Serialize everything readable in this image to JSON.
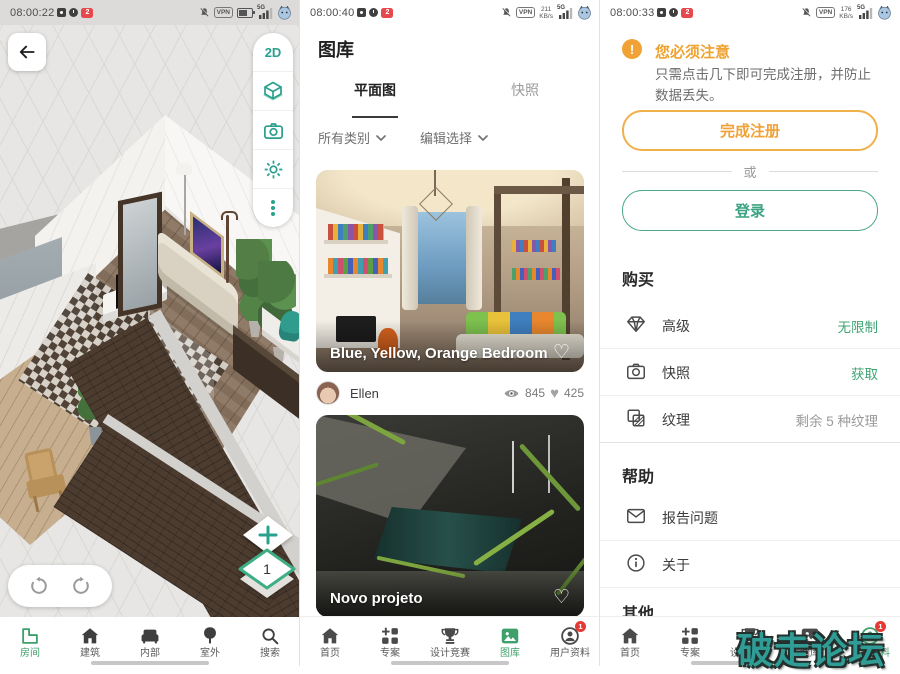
{
  "glyphs": {
    "heart_outline": "♡",
    "heart_filled": "♥",
    "plus": "+",
    "warning_mark": "!",
    "vpn": "VPN",
    "signal_5g": "5G"
  },
  "colors": {
    "accent_teal": "#2aa18f",
    "accent_green": "#3fa06c",
    "accent_orange": "#f0a236",
    "watermark_teal": "#2f9d95"
  },
  "watermark": "破走论坛",
  "panels": {
    "viewer": {
      "status": {
        "time": "08:00:22",
        "badge": "2"
      },
      "toolbar": {
        "mode_2d": "2D"
      },
      "controls": {
        "floor_level": "1"
      },
      "nav": [
        {
          "label": "房间",
          "active": true
        },
        {
          "label": "建筑"
        },
        {
          "label": "内部"
        },
        {
          "label": "室外"
        },
        {
          "label": "搜索"
        }
      ]
    },
    "gallery": {
      "status": {
        "time": "08:00:40",
        "badge": "2",
        "speed_value": "211",
        "speed_unit": "KB/s"
      },
      "title": "图库",
      "tabs": [
        {
          "label": "平面图",
          "active": true
        },
        {
          "label": "快照"
        }
      ],
      "filters": [
        {
          "label": "所有类别"
        },
        {
          "label": "编辑选择"
        }
      ],
      "cards": [
        {
          "title": "Blue, Yellow, Orange Bedroom",
          "author": "Ellen",
          "views": "845",
          "likes": "425"
        },
        {
          "title": "Novo projeto"
        }
      ],
      "nav": [
        {
          "label": "首页"
        },
        {
          "label": "专案"
        },
        {
          "label": "设计竞赛"
        },
        {
          "label": "图库",
          "active": true
        },
        {
          "label": "用户资料",
          "badge": "1"
        }
      ]
    },
    "profile": {
      "status": {
        "time": "08:00:33",
        "badge": "2",
        "speed_value": "176",
        "speed_unit": "KB/s"
      },
      "notice": {
        "title": "您必须注意",
        "body": "只需点击几下即可完成注册，并防止数据丢失。",
        "register_label": "完成注册",
        "or_label": "或",
        "login_label": "登录"
      },
      "sections": [
        {
          "title": "购买",
          "rows": [
            {
              "label": "高级",
              "value": "无限制"
            },
            {
              "label": "快照",
              "value": "获取"
            },
            {
              "label": "纹理",
              "value": "剩余 5 种纹理"
            }
          ]
        },
        {
          "title": "帮助",
          "rows": [
            {
              "label": "报告问题"
            },
            {
              "label": "关于"
            }
          ]
        },
        {
          "title": "其他",
          "rows": []
        }
      ],
      "nav": [
        {
          "label": "首页"
        },
        {
          "label": "专案"
        },
        {
          "label": "设计竞赛"
        },
        {
          "label": "图库"
        },
        {
          "label": "用户资料",
          "active": true,
          "badge": "1"
        }
      ]
    }
  }
}
